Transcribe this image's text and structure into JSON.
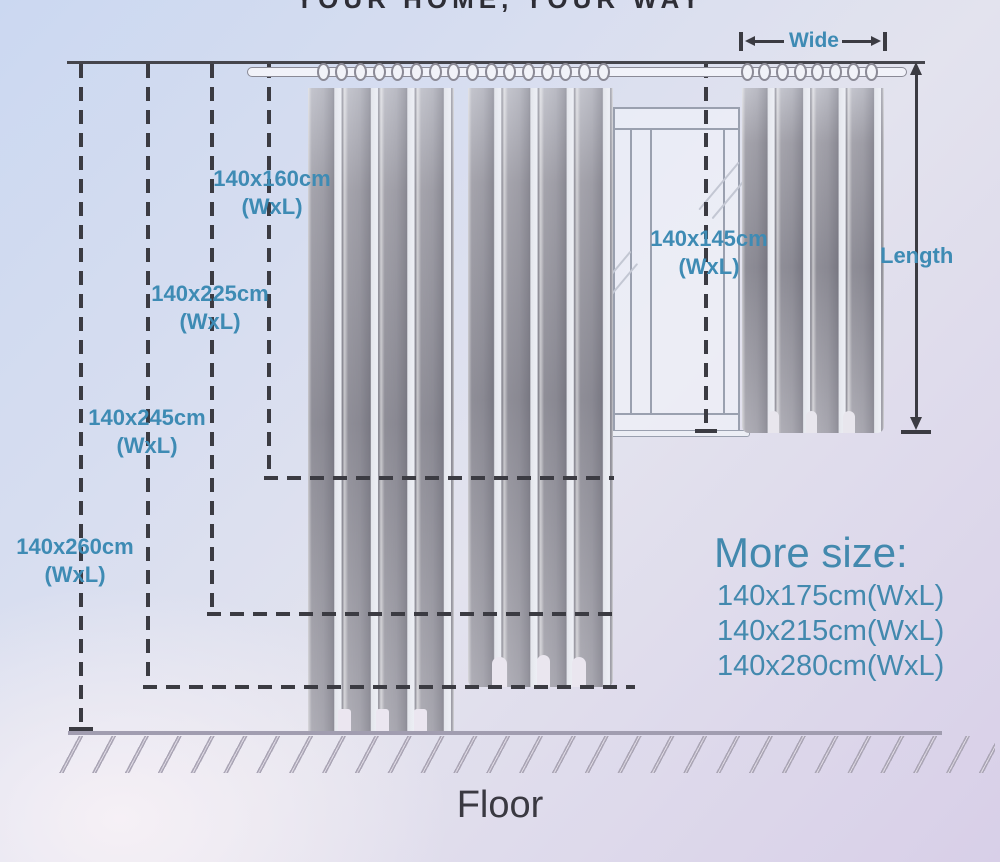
{
  "tagline": "YOUR HOME, YOUR WAY",
  "measurements": {
    "wide_label": "Wide",
    "length_label": "Length"
  },
  "size_labels": [
    {
      "size": "140x160cm",
      "suffix": "(WxL)"
    },
    {
      "size": "140x225cm",
      "suffix": "(WxL)"
    },
    {
      "size": "140x245cm",
      "suffix": "(WxL)"
    },
    {
      "size": "140x260cm",
      "suffix": "(WxL)"
    },
    {
      "size": "140x145cm",
      "suffix": "(WxL)"
    }
  ],
  "more_sizes": {
    "heading": "More size:",
    "items": [
      "140x175cm(WxL)",
      "140x215cm(WxL)",
      "140x280cm(WxL)"
    ]
  },
  "floor_label": "Floor",
  "colors": {
    "accent_teal": "#3e8bb4",
    "line_dark": "#3b3b42",
    "curtain_gray": "#908f98",
    "bg_top_left": "#cbd8f1",
    "bg_bottom_right": "#d8cfe8"
  }
}
